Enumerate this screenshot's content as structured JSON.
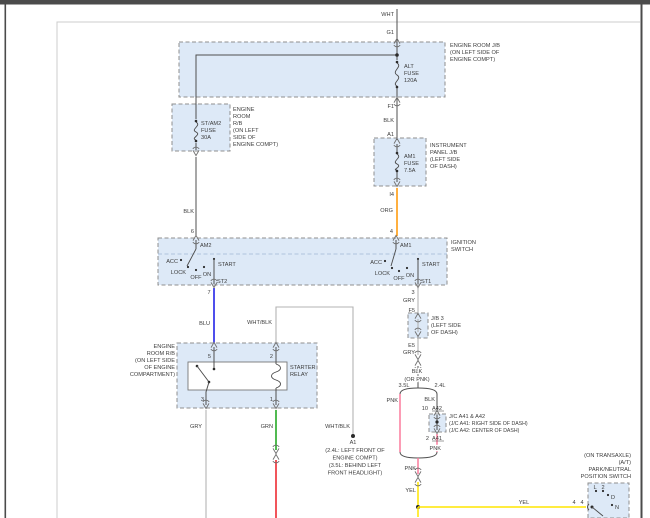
{
  "title": "Starting system wiring diagram",
  "colors": {
    "box_fill": "#dde9f7",
    "box_border": "#8f8f8f",
    "wire_dark": "#4f4f4f",
    "wire_gray": "#b3b3b3",
    "blue": "#1414e6",
    "orange": "#ff9500",
    "green": "#17a317",
    "red": "#ec1c24",
    "pink": "#fb7a9c",
    "yellow": "#ffe600"
  },
  "labels": {
    "wht": "WHT",
    "g1": "G1",
    "engine_room_jb": [
      "ENGINE ROOM J/B",
      "(ON LEFT SIDE OF",
      "ENGINE COMPT)"
    ],
    "alt_fuse": [
      "ALT",
      "FUSE",
      "120A"
    ],
    "f1": "F1",
    "blk_top": "BLK",
    "a1_conn": "A1",
    "engine_room_rb_fuse": [
      "ENGINE",
      "ROOM",
      "R/B",
      "(ON LEFT",
      "SIDE OF",
      "ENGINE COMPT)"
    ],
    "st_am2_fuse": [
      "ST/AM2",
      "FUSE",
      "30A"
    ],
    "instrument_panel_jb": [
      "INSTRUMENT",
      "PANEL J/B",
      "(LEFT SIDE",
      "OF DASH)"
    ],
    "am1_fuse": [
      "AM1",
      "FUSE",
      "7.5A"
    ],
    "i4": "I4",
    "org": "ORG",
    "blk_left": "BLK",
    "pin6": "6",
    "am2": "AM2",
    "pin4": "4",
    "am1": "AM1",
    "ignition_switch": [
      "IGNITION",
      "SWITCH"
    ],
    "acc_l": "ACC",
    "lock_l": "LOCK",
    "off_l": "OFF",
    "on_l": "ON",
    "start_l": "START",
    "st2": "ST2",
    "pin7": "7",
    "acc_r": "ACC",
    "lock_r": "LOCK",
    "off_r": "OFF",
    "on_r": "ON",
    "start_r": "START",
    "st1": "ST1",
    "pin3": "3",
    "blu": "BLU",
    "whtblk_relay": "WHT/BLK",
    "engine_room_rb_relay": [
      "ENGINE",
      "ROOM R/B",
      "(ON LEFT SIDE",
      "OF ENGINE",
      "COMPARTMENT)"
    ],
    "starter_relay": [
      "STARTER",
      "RELAY"
    ],
    "pin5": "5",
    "pin2_relay": "2",
    "pin3_relay": "3",
    "pin1_relay": "1",
    "gry_relay": "GRY",
    "grn": "GRN",
    "gry_ign": "GRY",
    "f5": "F5",
    "jb3": [
      "J/B 3",
      "(LEFT SIDE",
      "OF DASH)"
    ],
    "e5": "E5",
    "gry_jb3": "GRY",
    "blk_mid": "BLK",
    "or_pnk": "(OR PNK)",
    "v35": "3.5L",
    "v24": "2.4L",
    "pnk_35": "PNK",
    "blk_24": "BLK",
    "pin10": "10",
    "a42": "A42",
    "jc": [
      "J/C A41 & A42",
      "(J/C A41: RIGHT SIDE OF DASH)",
      "(J/C A42: CENTER OF DASH)"
    ],
    "pin2_jc": "2",
    "a41": "A41",
    "pnk_24": "PNK",
    "pnk_merge": "PNK",
    "yel_v": "YEL",
    "whtblk_gnd": "WHT/BLK",
    "a1_gnd": "A1",
    "gnd_note": [
      "(2.4L: LEFT FRONT OF",
      "ENGINE COMPT)",
      "(3.5L: BEHIND LEFT",
      "FRONT HEADLIGHT)"
    ],
    "yel_h": "YEL",
    "pin4_yel": "4",
    "pin4_pnp": "4",
    "pnp": [
      "(ON TRANSAXLE)",
      "(A/T)",
      "PARK/NEUTRAL",
      "POSITION SWITCH"
    ],
    "pos_l": "L",
    "pos_2": "2",
    "pos_d": "D",
    "pos_n": "N"
  }
}
